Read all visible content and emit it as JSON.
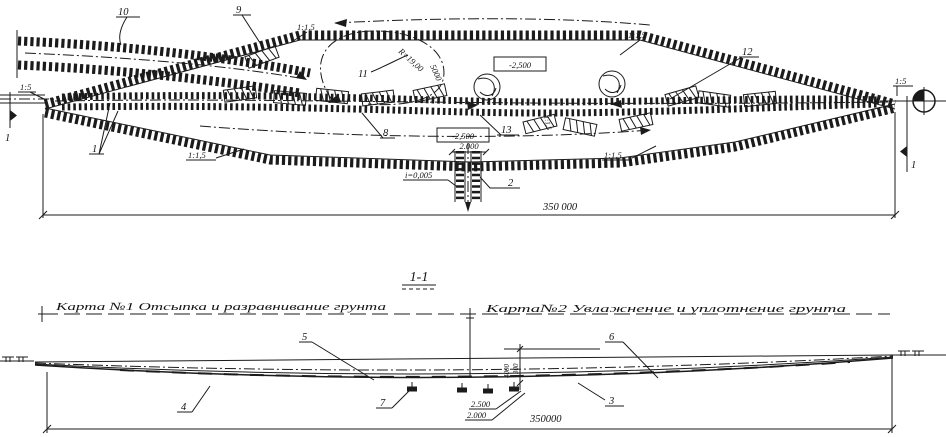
{
  "plan": {
    "callouts": {
      "c10": "10",
      "c9": "9",
      "c1": "1",
      "c11": "11",
      "c8": "8",
      "c13": "13",
      "c12": "12",
      "c2": "2"
    },
    "slopes": {
      "left_15": "1:5",
      "right_15": "1:5",
      "top_left": "1:1,5",
      "top_right": "1:1,5",
      "bottom_left": "1:1,5",
      "bottom_right": "1:1,5",
      "vertical": "1:1,5"
    },
    "elevations": {
      "upper": "-2,500",
      "lower": "-2,500"
    },
    "dims": {
      "overall": "350 000",
      "culvert_width": "2.000",
      "radius": "R=19,00",
      "ramp_width": "5000",
      "gradient": "i=0,005"
    },
    "section_markers": {
      "left": "1",
      "right": "1"
    }
  },
  "section": {
    "title": "1-1",
    "cards": {
      "card1": "Карта №1  Отсыпка и разравнивание грунта",
      "card2": "Карта№2  Увлажнение и уплотнение грунта"
    },
    "callouts": {
      "c3": "3",
      "c4": "4",
      "c5": "5",
      "c6": "6",
      "c7": "7"
    },
    "dims": {
      "width_top": "2.500",
      "width_bottom": "2.000",
      "overall": "350000",
      "v_left": "4000",
      "v_right": "300"
    }
  }
}
